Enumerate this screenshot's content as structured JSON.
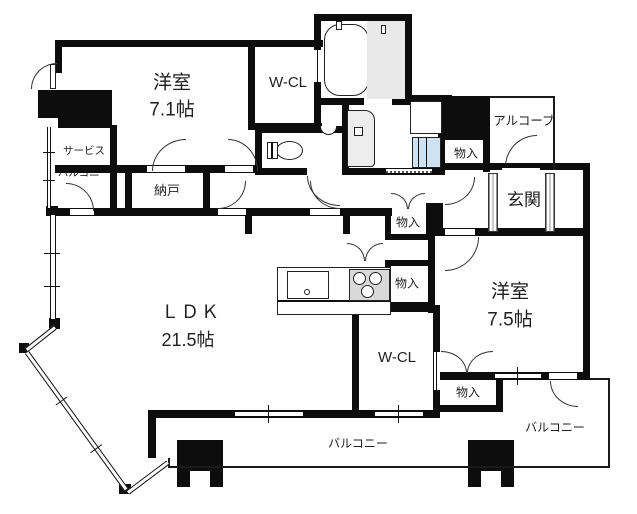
{
  "floorplan": {
    "rooms": {
      "bedroom1": {
        "name": "洋室",
        "size": "7.1帖"
      },
      "bedroom2": {
        "name": "洋室",
        "size": "7.5帖"
      },
      "ldk": {
        "name": "ＬＤＫ",
        "size": "21.5帖"
      },
      "wcl_top": {
        "name": "W-CL"
      },
      "wcl_bottom": {
        "name": "W-CL"
      },
      "nando": {
        "name": "納戸"
      },
      "genkan": {
        "name": "玄関"
      },
      "alcove": {
        "name": "アルコーブ"
      },
      "service_balcony": {
        "line1": "サービス",
        "line2": "バルコニー"
      },
      "balcony_main": {
        "name": "バルコニー"
      },
      "balcony_right": {
        "name": "バルコニー"
      },
      "storage_entrance": {
        "name": "物入"
      },
      "storage_hall": {
        "name": "物入"
      },
      "storage_kitchen": {
        "name": "物入"
      },
      "storage_bedroom2": {
        "name": "物入"
      }
    },
    "fixtures": [
      "bathtub",
      "shower-room",
      "vanity",
      "toilet",
      "corner-basin",
      "washing-machine",
      "kitchen-sink",
      "gas-stove"
    ],
    "colors": {
      "wall": "#0d0d0d",
      "shower_floor": "#e9e9e9",
      "stove": "#d9d9d9",
      "washing_machine": "#cfe2f2",
      "background": "#ffffff"
    }
  }
}
